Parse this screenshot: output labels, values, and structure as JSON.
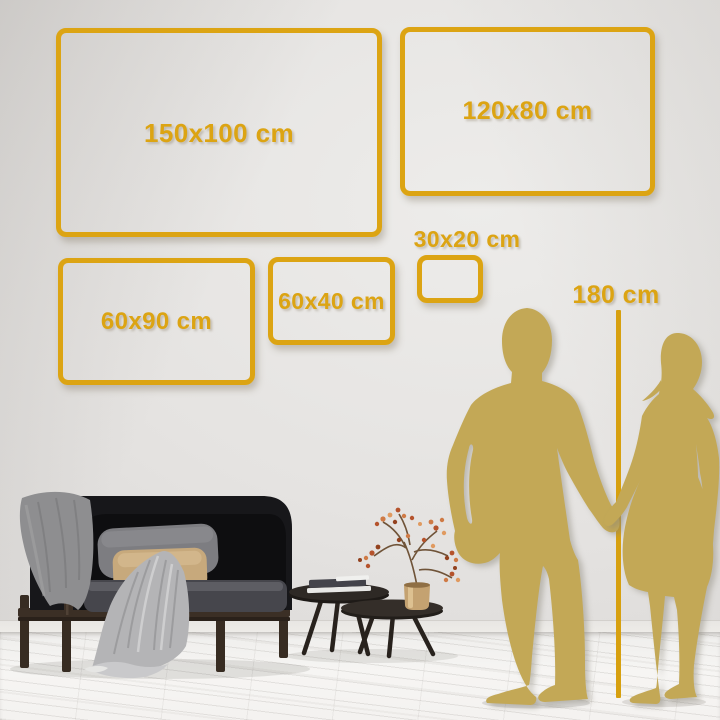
{
  "sizes": [
    {
      "id": "150x100",
      "label": "150x100 cm",
      "width_cm": 150,
      "height_cm": 100
    },
    {
      "id": "120x80",
      "label": "120x80 cm",
      "width_cm": 120,
      "height_cm": 80
    },
    {
      "id": "60x90",
      "label": "60x90 cm",
      "width_cm": 60,
      "height_cm": 90
    },
    {
      "id": "60x40",
      "label": "60x40 cm",
      "width_cm": 60,
      "height_cm": 40
    },
    {
      "id": "30x20",
      "label": "30x20 cm",
      "width_cm": 30,
      "height_cm": 20
    }
  ],
  "ruler": {
    "label": "180 cm",
    "height_cm": 180
  },
  "colors": {
    "frame_gold": "#DCA413",
    "silhouette_gold": "#C3A856",
    "ruler_gold": "#D7A00F",
    "wall": "#E2E0DE",
    "floor": "#F4F2F0"
  },
  "scene_objects": [
    "sofa",
    "gray-blanket",
    "gray-pillow",
    "tan-pillow",
    "coffee-table-large",
    "coffee-table-small",
    "books",
    "brass-vase",
    "branch-plant",
    "man-silhouette",
    "woman-silhouette",
    "height-ruler"
  ]
}
